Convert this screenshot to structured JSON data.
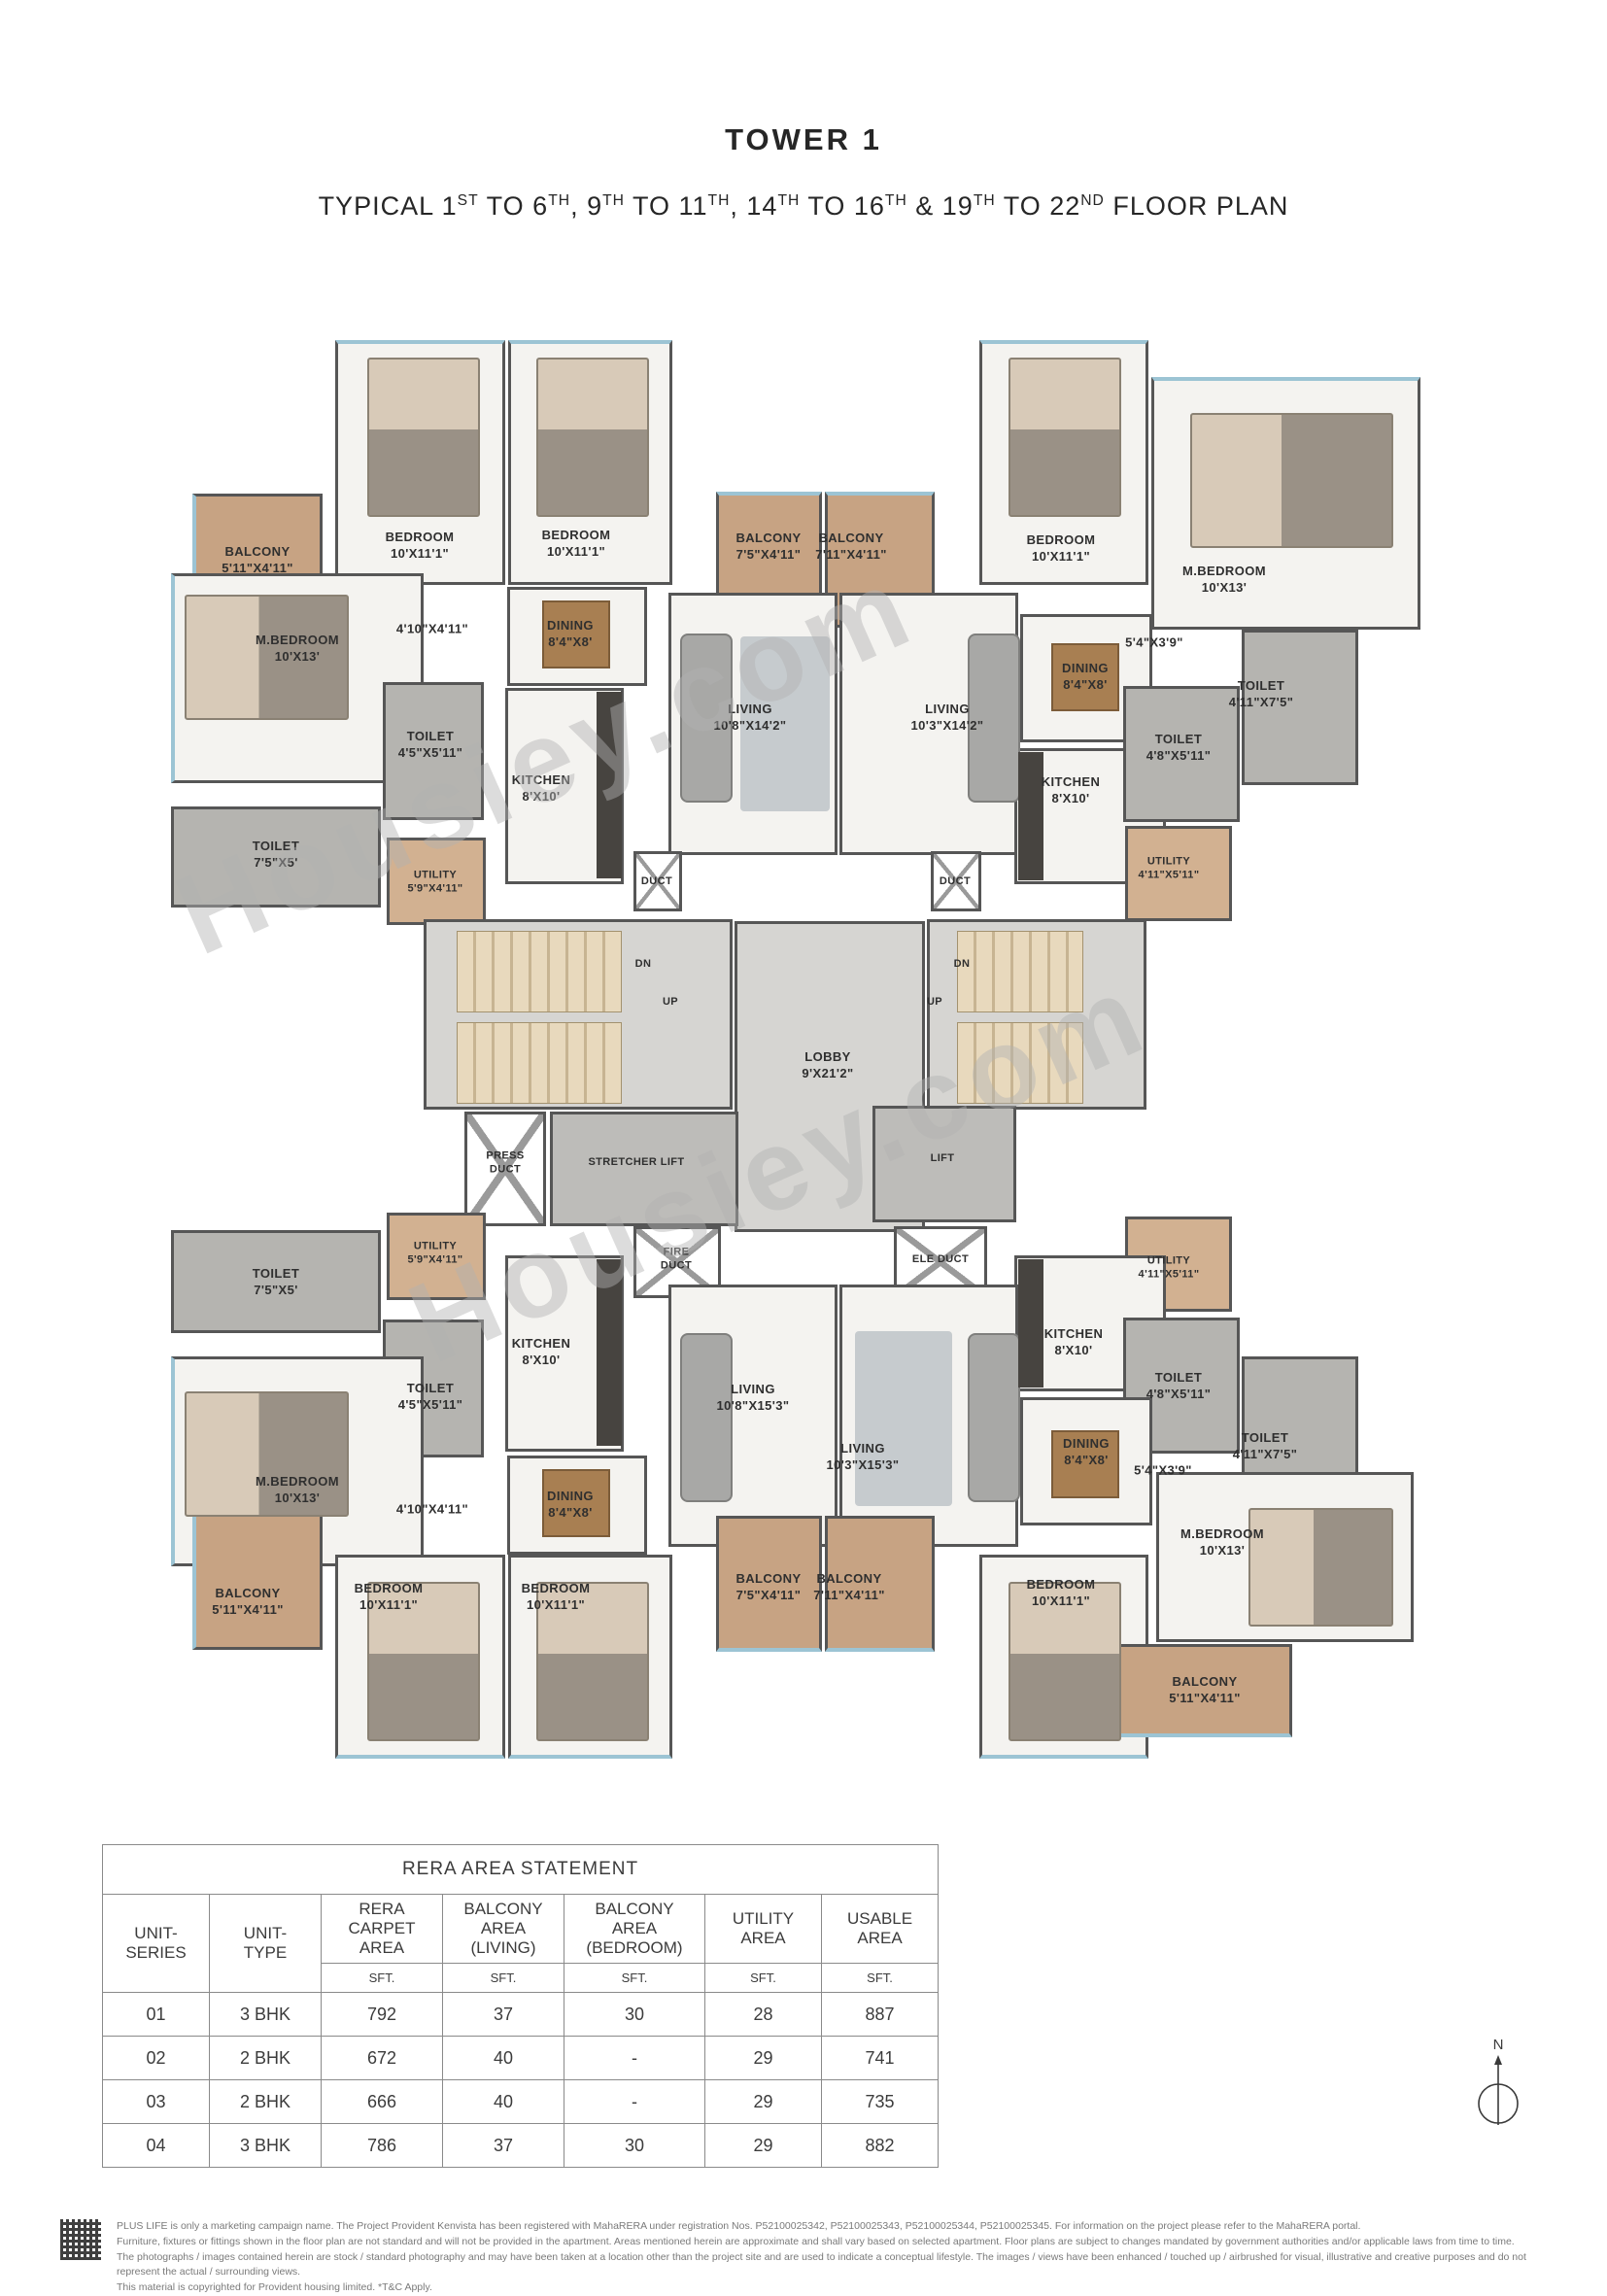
{
  "header": {
    "title": "TOWER 1",
    "subtitle_segments": [
      {
        "t": "TYPICAL 1"
      },
      {
        "t": "ST",
        "sup": true
      },
      {
        "t": " TO 6"
      },
      {
        "t": "TH",
        "sup": true
      },
      {
        "t": ", 9"
      },
      {
        "t": "TH",
        "sup": true
      },
      {
        "t": " TO 11"
      },
      {
        "t": "TH",
        "sup": true
      },
      {
        "t": ", 14"
      },
      {
        "t": "TH",
        "sup": true
      },
      {
        "t": " TO 16"
      },
      {
        "t": "TH",
        "sup": true
      },
      {
        "t": " & 19"
      },
      {
        "t": "TH",
        "sup": true
      },
      {
        "t": " TO 22"
      },
      {
        "t": "ND",
        "sup": true
      },
      {
        "t": " FLOOR PLAN"
      }
    ]
  },
  "plan": {
    "watermark": "Housiey.com",
    "rooms": [
      {
        "name": "BALCONY",
        "dims": "5'11\"X4'11\""
      },
      {
        "name": "BEDROOM",
        "dims": "10'X11'1\""
      },
      {
        "name": "BEDROOM",
        "dims": "10'X11'1\""
      },
      {
        "name": "BALCONY",
        "dims": "7'5\"X4'11\""
      },
      {
        "name": "BALCONY",
        "dims": "7'11\"X4'11\""
      },
      {
        "name": "BEDROOM",
        "dims": "10'X11'1\""
      },
      {
        "name": "M.BEDROOM",
        "dims": "10'X13'"
      },
      {
        "name": "M.BEDROOM",
        "dims": "10'X13'"
      },
      {
        "name": "4'10\"X4'11\"",
        "dims": ""
      },
      {
        "name": "DINING",
        "dims": "8'4\"X8'"
      },
      {
        "name": "LIVING",
        "dims": "10'8\"X14'2\""
      },
      {
        "name": "LIVING",
        "dims": "10'3\"X14'2\""
      },
      {
        "name": "DINING",
        "dims": "8'4\"X8'"
      },
      {
        "name": "5'4\"X3'9\"",
        "dims": ""
      },
      {
        "name": "TOILET",
        "dims": "4'11\"X7'5\""
      },
      {
        "name": "TOILET",
        "dims": "4'5\"X5'11\""
      },
      {
        "name": "KITCHEN",
        "dims": "8'X10'"
      },
      {
        "name": "KITCHEN",
        "dims": "8'X10'"
      },
      {
        "name": "TOILET",
        "dims": "4'8\"X5'11\""
      },
      {
        "name": "TOILET",
        "dims": "7'5\"X5'"
      },
      {
        "name": "UTILITY",
        "dims": "5'9\"X4'11\""
      },
      {
        "name": "DUCT",
        "dims": ""
      },
      {
        "name": "DUCT",
        "dims": ""
      },
      {
        "name": "UTILITY",
        "dims": "4'11\"X5'11\""
      },
      {
        "name": "DN",
        "dims": ""
      },
      {
        "name": "UP",
        "dims": ""
      },
      {
        "name": "DN",
        "dims": ""
      },
      {
        "name": "UP",
        "dims": ""
      },
      {
        "name": "LOBBY",
        "dims": "9'X21'2\""
      },
      {
        "name": "PRESS DUCT",
        "dims": ""
      },
      {
        "name": "STRETCHER LIFT",
        "dims": ""
      },
      {
        "name": "LIFT",
        "dims": ""
      },
      {
        "name": "FIRE DUCT",
        "dims": ""
      },
      {
        "name": "ELE DUCT",
        "dims": ""
      },
      {
        "name": "UTILITY",
        "dims": "5'9\"X4'11\""
      },
      {
        "name": "TOILET",
        "dims": "7'5\"X5'"
      },
      {
        "name": "TOILET",
        "dims": "4'5\"X5'11\""
      },
      {
        "name": "KITCHEN",
        "dims": "8'X10'"
      },
      {
        "name": "UTILITY",
        "dims": "4'11\"X5'11\""
      },
      {
        "name": "KITCHEN",
        "dims": "8'X10'"
      },
      {
        "name": "TOILET",
        "dims": "4'8\"X5'11\""
      },
      {
        "name": "TOILET",
        "dims": "4'11\"X7'5\""
      },
      {
        "name": "M.BEDROOM",
        "dims": "10'X13'"
      },
      {
        "name": "4'10\"X4'11\"",
        "dims": ""
      },
      {
        "name": "DINING",
        "dims": "8'4\"X8'"
      },
      {
        "name": "LIVING",
        "dims": "10'8\"X15'3\""
      },
      {
        "name": "LIVING",
        "dims": "10'3\"X15'3\""
      },
      {
        "name": "DINING",
        "dims": "8'4\"X8'"
      },
      {
        "name": "5'4\"X3'9\"",
        "dims": ""
      },
      {
        "name": "M.BEDROOM",
        "dims": "10'X13'"
      },
      {
        "name": "BALCONY",
        "dims": "5'11\"X4'11\""
      },
      {
        "name": "BEDROOM",
        "dims": "10'X11'1\""
      },
      {
        "name": "BEDROOM",
        "dims": "10'X11'1\""
      },
      {
        "name": "BALCONY",
        "dims": "7'5\"X4'11\""
      },
      {
        "name": "BALCONY",
        "dims": "7'11\"X4'11\""
      },
      {
        "name": "BEDROOM",
        "dims": "10'X11'1\""
      },
      {
        "name": "BALCONY",
        "dims": "5'11\"X4'11\""
      }
    ]
  },
  "table": {
    "title": "RERA AREA STATEMENT",
    "headers": [
      "UNIT-\nSERIES",
      "UNIT-\nTYPE",
      "RERA\nCARPET\nAREA",
      "BALCONY\nAREA\n(LIVING)",
      "BALCONY\nAREA\n(BEDROOM)",
      "UTILITY\nAREA",
      "USABLE\nAREA"
    ],
    "sft": "SFT.",
    "rows": [
      [
        "01",
        "3 BHK",
        "792",
        "37",
        "30",
        "28",
        "887"
      ],
      [
        "02",
        "2 BHK",
        "672",
        "40",
        "-",
        "29",
        "741"
      ],
      [
        "03",
        "2 BHK",
        "666",
        "40",
        "-",
        "29",
        "735"
      ],
      [
        "04",
        "3 BHK",
        "786",
        "37",
        "30",
        "29",
        "882"
      ]
    ]
  },
  "compass": {
    "label": "N"
  },
  "footer": {
    "lines": [
      "PLUS LIFE is only a marketing campaign name. The Project Provident Kenvista has been registered with MahaRERA under registration Nos. P52100025342, P52100025343, P52100025344, P52100025345. For information on the project please refer to the MahaRERA portal.",
      "Furniture, fixtures or fittings shown in the floor plan are not standard and will not be provided in the apartment. Areas mentioned herein are approximate and shall vary based on selected apartment. Floor plans are subject to changes mandated by government authorities and/or applicable laws from time to time.",
      "The photographs / images contained herein are stock / standard photography and may have been taken at a location other than the project site and are used to indicate a conceptual lifestyle. The images / views have been enhanced / touched up / airbrushed for visual, illustrative and creative purposes and do not represent the actual / surrounding views.",
      "This material is copyrighted for Provident housing limited. *T&C Apply."
    ]
  }
}
